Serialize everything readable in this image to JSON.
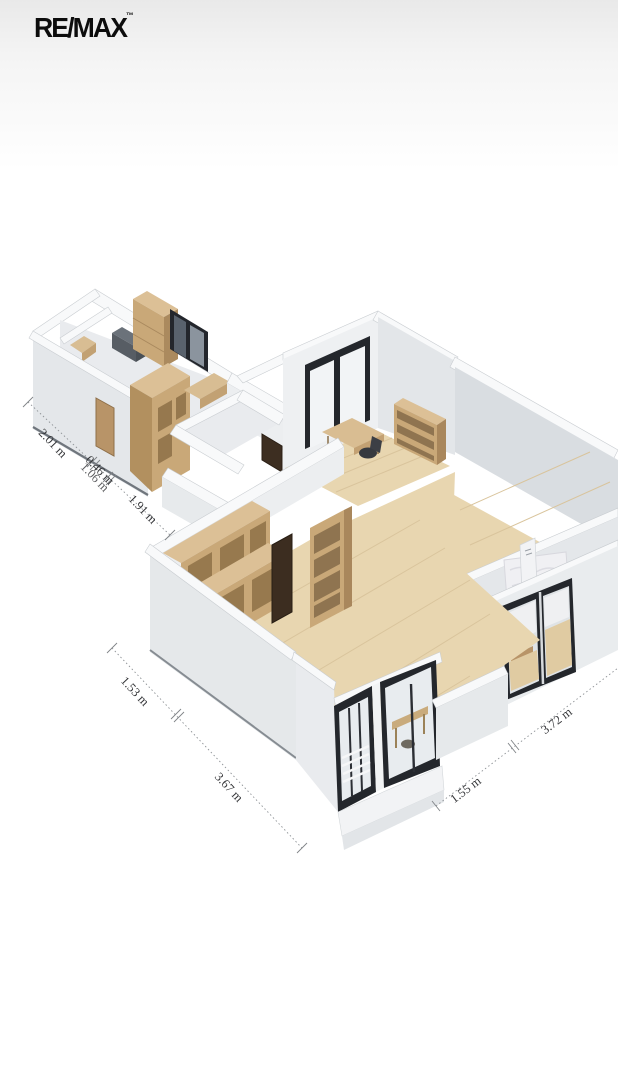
{
  "logo": {
    "text": "RE/MAX",
    "trademark": "™"
  },
  "floorplan": {
    "room_label_partial": "ice",
    "dimensions": [
      {
        "id": "left-1",
        "label": "2.01 m"
      },
      {
        "id": "left-2-back",
        "label": "1.06 m"
      },
      {
        "id": "left-2-front",
        "label": "0.46 m"
      },
      {
        "id": "left-3",
        "label": "1.91 m"
      },
      {
        "id": "bottomleft-1",
        "label": "1.53 m"
      },
      {
        "id": "bottomleft-2",
        "label": "3.67 m"
      },
      {
        "id": "bottomright-1",
        "label": "1.55 m"
      },
      {
        "id": "bottomright-2",
        "label": "3.72 m"
      }
    ],
    "colors": {
      "wall": "#eceef0",
      "wall_shade": "#dfe3e6",
      "wood": "#c9a878",
      "floor": "#e8d6b0",
      "window_frame": "#24272c",
      "logo": "#0c0c0c"
    }
  }
}
